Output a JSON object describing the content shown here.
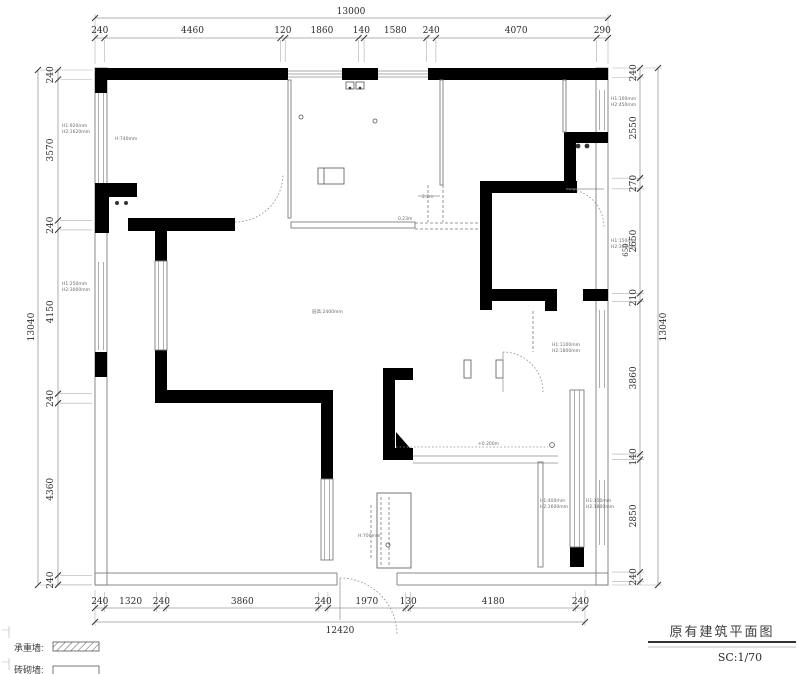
{
  "title": {
    "name": "原有建筑平面图",
    "scale": "SC:1/70"
  },
  "legend": {
    "row1_label": "承重墙:",
    "row2_label": "砖砌墙:"
  },
  "dims": {
    "top": {
      "total": "13000",
      "segments": [
        "240",
        "4460",
        "120",
        "1860",
        "140",
        "1580",
        "240",
        "4070",
        "290"
      ]
    },
    "left": {
      "total": "13040",
      "segments": [
        "240",
        "3570",
        "240",
        "4150",
        "240",
        "4360",
        "240"
      ]
    },
    "right": {
      "total": "13040",
      "segments": [
        "240",
        "2550",
        "270",
        "2650",
        "210",
        "3860",
        "140",
        "2850",
        "240"
      ],
      "inner": "650"
    },
    "bottom": {
      "total": "12420",
      "segments": [
        "240",
        "1320",
        "240",
        "3860",
        "240",
        "1970",
        "130",
        "4180",
        "240"
      ]
    }
  },
  "annotations": {
    "tl_a": "H1:920mm",
    "tl_b": "H2:1620mm",
    "tl_c": "H:740mm",
    "ml_a": "H1:250mm",
    "ml_b": "H2:3000mm",
    "tr_a": "H1:100mm",
    "tr_b": "H2:450mm",
    "mr_a": "H1:150mm",
    "mr_b": "H2:300mm",
    "beam_a": "0.23m",
    "beam_b": "2.2m",
    "center": "层高:2400mm",
    "level": "+0.200m",
    "flue": "H:700mm",
    "door_a": "H1:1100mm",
    "door_b": "H2:1800mm",
    "br_a": "H1:400mm",
    "br_b": "H2:1600mm",
    "br_c": "H1:150mm",
    "br_d": "H2:1800mm"
  }
}
